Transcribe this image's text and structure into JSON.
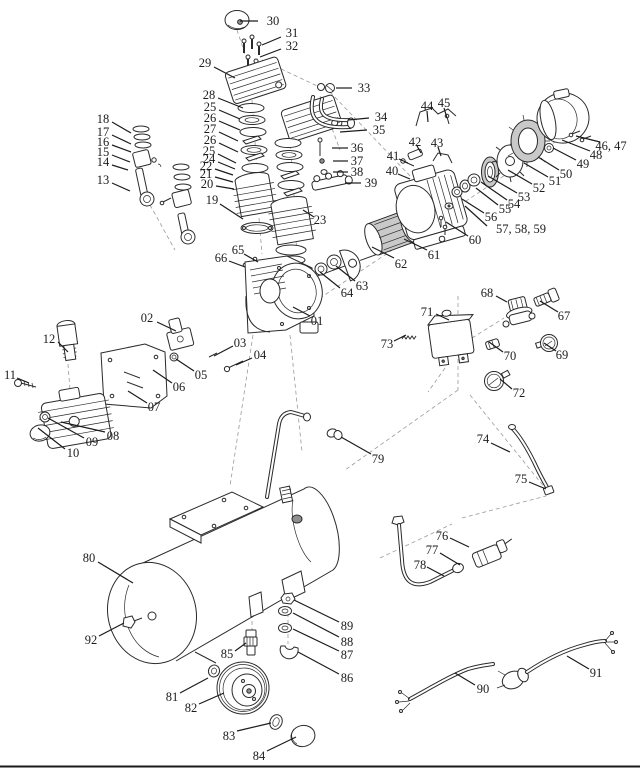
{
  "diagram": {
    "type": "exploded-parts-diagram",
    "subject": "air-compressor-parts-breakdown",
    "ink_color": "#2a2a2a",
    "label_color": "#1c1c1c",
    "background": "#ffffff",
    "callouts": [
      {
        "text": "30",
        "tx": 273,
        "ty": 21,
        "x1": 258,
        "y1": 21,
        "x2": 240,
        "y2": 21
      },
      {
        "text": "31",
        "tx": 292,
        "ty": 33,
        "x1": 281,
        "y1": 37,
        "x2": 262,
        "y2": 45
      },
      {
        "text": "32",
        "tx": 292,
        "ty": 46,
        "x1": 281,
        "y1": 49,
        "x2": 260,
        "y2": 57
      },
      {
        "text": "29",
        "tx": 205,
        "ty": 63,
        "x1": 214,
        "y1": 67,
        "x2": 235,
        "y2": 78
      },
      {
        "text": "33",
        "tx": 364,
        "ty": 88,
        "x1": 352,
        "y1": 88,
        "x2": 336,
        "y2": 88
      },
      {
        "text": "34",
        "tx": 381,
        "ty": 117,
        "x1": 369,
        "y1": 118,
        "x2": 348,
        "y2": 120
      },
      {
        "text": "35",
        "tx": 379,
        "ty": 130,
        "x1": 367,
        "y1": 130,
        "x2": 340,
        "y2": 132
      },
      {
        "text": "28",
        "tx": 209,
        "ty": 95,
        "x1": 218,
        "y1": 98,
        "x2": 243,
        "y2": 108
      },
      {
        "text": "25",
        "tx": 210,
        "ty": 107,
        "x1": 219,
        "y1": 110,
        "x2": 240,
        "y2": 119
      },
      {
        "text": "26",
        "tx": 210,
        "ty": 118,
        "x1": 219,
        "y1": 121,
        "x2": 240,
        "y2": 130
      },
      {
        "text": "27",
        "tx": 210,
        "ty": 129,
        "x1": 219,
        "y1": 132,
        "x2": 238,
        "y2": 141
      },
      {
        "text": "26",
        "tx": 210,
        "ty": 140,
        "x1": 219,
        "y1": 143,
        "x2": 238,
        "y2": 152
      },
      {
        "text": "25",
        "tx": 209,
        "ty": 151,
        "x1": 218,
        "y1": 154,
        "x2": 236,
        "y2": 163
      },
      {
        "text": "24",
        "tx": 209,
        "ty": 159,
        "x1": 218,
        "y1": 162,
        "x2": 235,
        "y2": 169
      },
      {
        "text": "22",
        "tx": 206,
        "ty": 166,
        "x1": 215,
        "y1": 169,
        "x2": 233,
        "y2": 175
      },
      {
        "text": "21",
        "tx": 206,
        "ty": 174,
        "x1": 215,
        "y1": 177,
        "x2": 233,
        "y2": 182
      },
      {
        "text": "20",
        "tx": 207,
        "ty": 184,
        "x1": 216,
        "y1": 186,
        "x2": 234,
        "y2": 189
      },
      {
        "text": "19",
        "tx": 212,
        "ty": 200,
        "x1": 220,
        "y1": 204,
        "x2": 243,
        "y2": 219
      },
      {
        "text": "18",
        "tx": 103,
        "ty": 119,
        "x1": 112,
        "y1": 122,
        "x2": 131,
        "y2": 133
      },
      {
        "text": "17",
        "tx": 103,
        "ty": 132,
        "x1": 112,
        "y1": 135,
        "x2": 131,
        "y2": 144
      },
      {
        "text": "16",
        "tx": 103,
        "ty": 142,
        "x1": 112,
        "y1": 145,
        "x2": 131,
        "y2": 152
      },
      {
        "text": "15",
        "tx": 103,
        "ty": 152,
        "x1": 112,
        "y1": 155,
        "x2": 130,
        "y2": 162
      },
      {
        "text": "14",
        "tx": 103,
        "ty": 162,
        "x1": 112,
        "y1": 165,
        "x2": 128,
        "y2": 170
      },
      {
        "text": "13",
        "tx": 103,
        "ty": 180,
        "x1": 112,
        "y1": 183,
        "x2": 130,
        "y2": 191
      },
      {
        "text": "36",
        "tx": 357,
        "ty": 148,
        "x1": 348,
        "y1": 148,
        "x2": 332,
        "y2": 148
      },
      {
        "text": "37",
        "tx": 357,
        "ty": 161,
        "x1": 348,
        "y1": 161,
        "x2": 333,
        "y2": 161
      },
      {
        "text": "38",
        "tx": 357,
        "ty": 172,
        "x1": 348,
        "y1": 172,
        "x2": 333,
        "y2": 172
      },
      {
        "text": "39",
        "tx": 371,
        "ty": 183,
        "x1": 361,
        "y1": 183,
        "x2": 345,
        "y2": 183
      },
      {
        "text": "44",
        "tx": 427,
        "ty": 106,
        "x1": 427,
        "y1": 111,
        "x2": 428,
        "y2": 122
      },
      {
        "text": "45",
        "tx": 444,
        "ty": 103,
        "x1": 444,
        "y1": 108,
        "x2": 447,
        "y2": 118
      },
      {
        "text": "42",
        "tx": 415,
        "ty": 142,
        "x1": 417,
        "y1": 146,
        "x2": 421,
        "y2": 153
      },
      {
        "text": "43",
        "tx": 437,
        "ty": 143,
        "x1": 438,
        "y1": 147,
        "x2": 441,
        "y2": 156
      },
      {
        "text": "41",
        "tx": 393,
        "ty": 156,
        "x1": 399,
        "y1": 159,
        "x2": 408,
        "y2": 163
      },
      {
        "text": "40",
        "tx": 392,
        "ty": 171,
        "x1": 398,
        "y1": 174,
        "x2": 410,
        "y2": 179
      },
      {
        "text": "46, 47",
        "tx": 611,
        "ty": 146,
        "x1": 600,
        "y1": 142,
        "x2": 576,
        "y2": 136
      },
      {
        "text": "48",
        "tx": 596,
        "ty": 155,
        "x1": 590,
        "y1": 151,
        "x2": 562,
        "y2": 140
      },
      {
        "text": "49",
        "tx": 583,
        "ty": 164,
        "x1": 576,
        "y1": 160,
        "x2": 553,
        "y2": 148
      },
      {
        "text": "50",
        "tx": 566,
        "ty": 174,
        "x1": 559,
        "y1": 170,
        "x2": 538,
        "y2": 157
      },
      {
        "text": "51",
        "tx": 555,
        "ty": 181,
        "x1": 548,
        "y1": 177,
        "x2": 524,
        "y2": 163
      },
      {
        "text": "52",
        "tx": 539,
        "ty": 188,
        "x1": 532,
        "y1": 184,
        "x2": 508,
        "y2": 170
      },
      {
        "text": "53",
        "tx": 524,
        "ty": 197,
        "x1": 517,
        "y1": 193,
        "x2": 488,
        "y2": 176
      },
      {
        "text": "54",
        "tx": 514,
        "ty": 204,
        "x1": 507,
        "y1": 200,
        "x2": 481,
        "y2": 182
      },
      {
        "text": "55",
        "tx": 505,
        "ty": 209,
        "x1": 498,
        "y1": 205,
        "x2": 476,
        "y2": 188
      },
      {
        "text": "56",
        "tx": 491,
        "ty": 217,
        "x1": 484,
        "y1": 213,
        "x2": 462,
        "y2": 199
      },
      {
        "text": "57, 58, 59",
        "tx": 521,
        "ty": 229,
        "x1": 487,
        "y1": 226,
        "x2": 465,
        "y2": 206
      },
      {
        "text": "60",
        "tx": 475,
        "ty": 240,
        "x1": 468,
        "y1": 236,
        "x2": 446,
        "y2": 222
      },
      {
        "text": "61",
        "tx": 434,
        "ty": 255,
        "x1": 427,
        "y1": 250,
        "x2": 404,
        "y2": 239
      },
      {
        "text": "62",
        "tx": 401,
        "ty": 264,
        "x1": 394,
        "y1": 258,
        "x2": 372,
        "y2": 247
      },
      {
        "text": "63",
        "tx": 362,
        "ty": 286,
        "x1": 355,
        "y1": 281,
        "x2": 336,
        "y2": 266
      },
      {
        "text": "64",
        "tx": 347,
        "ty": 293,
        "x1": 340,
        "y1": 288,
        "x2": 320,
        "y2": 272
      },
      {
        "text": "65",
        "tx": 238,
        "ty": 250,
        "x1": 244,
        "y1": 254,
        "x2": 258,
        "y2": 262
      },
      {
        "text": "66",
        "tx": 221,
        "ty": 258,
        "x1": 229,
        "y1": 261,
        "x2": 245,
        "y2": 267
      },
      {
        "text": "23",
        "tx": 320,
        "ty": 220,
        "x1": 314,
        "y1": 217,
        "x2": 303,
        "y2": 210
      },
      {
        "text": "01",
        "tx": 317,
        "ty": 321,
        "x1": 310,
        "y1": 316,
        "x2": 293,
        "y2": 307
      },
      {
        "text": "02",
        "tx": 147,
        "ty": 318,
        "x1": 157,
        "y1": 322,
        "x2": 176,
        "y2": 331
      },
      {
        "text": "03",
        "tx": 240,
        "ty": 343,
        "x1": 233,
        "y1": 346,
        "x2": 214,
        "y2": 356
      },
      {
        "text": "04",
        "tx": 260,
        "ty": 355,
        "x1": 252,
        "y1": 358,
        "x2": 236,
        "y2": 365
      },
      {
        "text": "05",
        "tx": 201,
        "ty": 375,
        "x1": 194,
        "y1": 371,
        "x2": 176,
        "y2": 359
      },
      {
        "text": "06",
        "tx": 179,
        "ty": 387,
        "x1": 172,
        "y1": 383,
        "x2": 153,
        "y2": 370
      },
      {
        "text": "07",
        "tx": 154,
        "ty": 407,
        "x1": 147,
        "y1": 403,
        "x2": 128,
        "y2": 391
      },
      {
        "text": "12",
        "tx": 49,
        "ty": 339,
        "x1": 58,
        "y1": 342,
        "x2": 68,
        "y2": 352
      },
      {
        "text": "11",
        "tx": 10,
        "ty": 375,
        "x1": 17,
        "y1": 378,
        "x2": 29,
        "y2": 383
      },
      {
        "text": "08",
        "tx": 113,
        "ty": 436,
        "x1": 105,
        "y1": 432,
        "x2": 61,
        "y2": 422
      },
      {
        "text": "09",
        "tx": 92,
        "ty": 442,
        "x1": 84,
        "y1": 438,
        "x2": 48,
        "y2": 418
      },
      {
        "text": "10",
        "tx": 73,
        "ty": 453,
        "x1": 65,
        "y1": 449,
        "x2": 38,
        "y2": 428
      },
      {
        "text": "68",
        "tx": 487,
        "ty": 293,
        "x1": 496,
        "y1": 296,
        "x2": 507,
        "y2": 302
      },
      {
        "text": "67",
        "tx": 564,
        "ty": 316,
        "x1": 558,
        "y1": 312,
        "x2": 540,
        "y2": 301
      },
      {
        "text": "71",
        "tx": 427,
        "ty": 312,
        "x1": 436,
        "y1": 314,
        "x2": 449,
        "y2": 320
      },
      {
        "text": "70",
        "tx": 510,
        "ty": 356,
        "x1": 503,
        "y1": 352,
        "x2": 489,
        "y2": 342
      },
      {
        "text": "69",
        "tx": 562,
        "ty": 355,
        "x1": 556,
        "y1": 351,
        "x2": 544,
        "y2": 343
      },
      {
        "text": "72",
        "tx": 519,
        "ty": 393,
        "x1": 512,
        "y1": 389,
        "x2": 500,
        "y2": 379
      },
      {
        "text": "73",
        "tx": 387,
        "ty": 344,
        "x1": 394,
        "y1": 341,
        "x2": 406,
        "y2": 335
      },
      {
        "text": "74",
        "tx": 483,
        "ty": 439,
        "x1": 491,
        "y1": 443,
        "x2": 510,
        "y2": 452
      },
      {
        "text": "75",
        "tx": 521,
        "ty": 479,
        "x1": 529,
        "y1": 482,
        "x2": 546,
        "y2": 489
      },
      {
        "text": "76",
        "tx": 442,
        "ty": 536,
        "x1": 450,
        "y1": 538,
        "x2": 469,
        "y2": 547
      },
      {
        "text": "77",
        "tx": 432,
        "ty": 550,
        "x1": 440,
        "y1": 553,
        "x2": 460,
        "y2": 565
      },
      {
        "text": "78",
        "tx": 420,
        "ty": 565,
        "x1": 427,
        "y1": 567,
        "x2": 444,
        "y2": 576
      },
      {
        "text": "79",
        "tx": 378,
        "ty": 459,
        "x1": 371,
        "y1": 454,
        "x2": 341,
        "y2": 437
      },
      {
        "text": "80",
        "tx": 89,
        "ty": 558,
        "x1": 98,
        "y1": 562,
        "x2": 133,
        "y2": 583
      },
      {
        "text": "92",
        "tx": 91,
        "ty": 640,
        "x1": 99,
        "y1": 636,
        "x2": 124,
        "y2": 623
      },
      {
        "text": "85",
        "tx": 227,
        "ty": 654,
        "x1": 235,
        "y1": 651,
        "x2": 246,
        "y2": 643
      },
      {
        "text": "81",
        "tx": 172,
        "ty": 697,
        "x1": 180,
        "y1": 693,
        "x2": 208,
        "y2": 678
      },
      {
        "text": "82",
        "tx": 191,
        "ty": 708,
        "x1": 199,
        "y1": 704,
        "x2": 224,
        "y2": 693
      },
      {
        "text": "83",
        "tx": 229,
        "ty": 736,
        "x1": 237,
        "y1": 731,
        "x2": 271,
        "y2": 723
      },
      {
        "text": "84",
        "tx": 259,
        "ty": 756,
        "x1": 267,
        "y1": 751,
        "x2": 296,
        "y2": 737
      },
      {
        "text": "89",
        "tx": 347,
        "ty": 626,
        "x1": 339,
        "y1": 622,
        "x2": 294,
        "y2": 600
      },
      {
        "text": "88",
        "tx": 347,
        "ty": 642,
        "x1": 339,
        "y1": 637,
        "x2": 293,
        "y2": 613
      },
      {
        "text": "87",
        "tx": 347,
        "ty": 655,
        "x1": 339,
        "y1": 651,
        "x2": 293,
        "y2": 629
      },
      {
        "text": "86",
        "tx": 347,
        "ty": 678,
        "x1": 339,
        "y1": 674,
        "x2": 298,
        "y2": 652
      },
      {
        "text": "90",
        "tx": 483,
        "ty": 689,
        "x1": 475,
        "y1": 685,
        "x2": 455,
        "y2": 673
      },
      {
        "text": "91",
        "tx": 596,
        "ty": 673,
        "x1": 589,
        "y1": 669,
        "x2": 567,
        "y2": 656
      }
    ]
  }
}
